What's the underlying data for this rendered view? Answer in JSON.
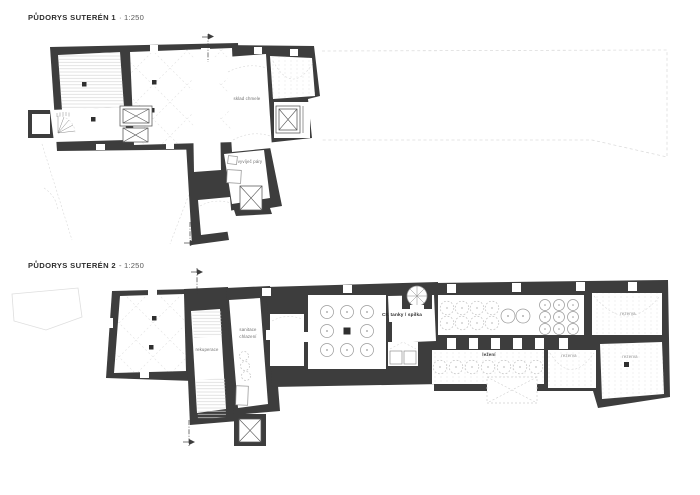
{
  "canvas": {
    "width": 700,
    "height": 495,
    "background": "#ffffff"
  },
  "colors": {
    "wall": "#3d3d3d",
    "room": "#ffffff",
    "texture": "#e2e2e2",
    "tank_outline": "#9a9a9a",
    "label_text": "#6f6f6f",
    "title_text": "#2e2e2e"
  },
  "plan1": {
    "title": "PŮDORYS SUTERÉN 1",
    "scale": "· 1:250",
    "labels": {
      "sklad_chmele": "sklad chmele",
      "vyvijec_pary": "vyvíječ páry"
    }
  },
  "plan2": {
    "title": "PŮDORYS SUTERÉN 2",
    "scale": "- 1:250",
    "labels": {
      "rekuperace": "rekuperace",
      "sanitace_line1": "sanitace",
      "sanitace_line2": "chlazení",
      "ck_tanky": "CK tanky / spilka",
      "lezeni": "ležení",
      "rezerva_top_right": "rezerva",
      "rezerva_bottom_middle": "rezerva",
      "rezerva_bottom_right": "rezerva"
    }
  }
}
